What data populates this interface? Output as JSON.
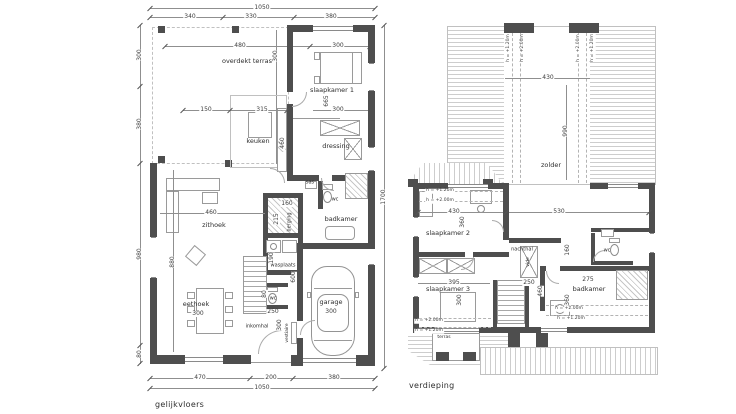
{
  "sheet": {
    "ground_title": "gelijkvloers",
    "upper_title": "verdieping"
  },
  "ground": {
    "rooms": {
      "terras": "overdekt terras",
      "keuken": "keuken",
      "sk1": "slaapkamer 1",
      "dressing": "dressing",
      "sas": "sas",
      "wc1": "wc",
      "badkamer": "badkamer",
      "zithoek": "zithoek",
      "berging": "berging",
      "wasplaats": "wasplaats",
      "eethoek": "eethoek",
      "wc2": "wc",
      "inkomhal": "inkomhal",
      "vestiaire": "vestiaire",
      "garage": "garage"
    },
    "dims": {
      "t1050": "1050",
      "t340": "340",
      "t330": "330",
      "t380": "380",
      "l300": "300",
      "l380": "380",
      "l980": "980",
      "l80": "80",
      "r1700": "1700",
      "b470": "470",
      "b200": "200",
      "b380": "380",
      "b1050": "1050",
      "terras480": "480",
      "terras300": "300",
      "sk1w300t": "300",
      "k150": "150",
      "k315": "315",
      "k460": "460",
      "sk1h665": "665",
      "sk1w300": "300",
      "z460": "460",
      "z880": "880",
      "be160": "160",
      "be215": "215",
      "wp190": "190",
      "e300": "300",
      "wc80": "80",
      "i250": "250",
      "i300": "300",
      "g300": "300",
      "g600": "600"
    }
  },
  "upper": {
    "rooms": {
      "zolder": "zolder",
      "sk2": "slaapkamer 2",
      "nachthal": "nachthal",
      "wc": "wc",
      "badkamer": "badkamer",
      "sk3": "slaapkamer 3",
      "terras": "terras",
      "vide": "vide"
    },
    "dims": {
      "z430": "430",
      "z990": "990",
      "sk2w430": "430",
      "h530": "530",
      "sk2h360": "360",
      "sk3w395": "395",
      "t250": "250",
      "h160": "160",
      "t460": "460",
      "sk3h300": "300",
      "bad275": "275",
      "bad360": "360"
    },
    "h": {
      "h120": "h = +1.20m",
      "h200": "h = +2.00m"
    }
  }
}
